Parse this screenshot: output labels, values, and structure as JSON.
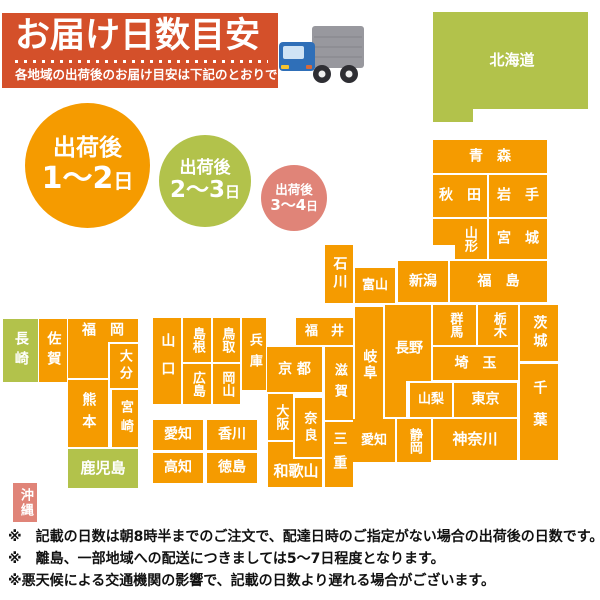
{
  "header": {
    "title": "お届け日数目安",
    "subtitle": "各地域の出荷後のお届け目安は下記のとおりです",
    "bg_color": "#d4502a",
    "truck": {
      "box_color": "#98989e",
      "box_line_color": "#8a8a91",
      "cab_color": "#2f6fb8",
      "window_color": "#cfe3f5",
      "wheel_color": "#2e2e33",
      "hub_color": "#efefef",
      "light_color": "#f5c431"
    }
  },
  "legend": {
    "circles": [
      {
        "prefix": "出荷後",
        "range": "1〜2",
        "unit": "日",
        "color": "#f59b00"
      },
      {
        "prefix": "出荷後",
        "range": "2〜3",
        "unit": "日",
        "color": "#b2c24b"
      },
      {
        "prefix": "出荷後",
        "range": "3〜4",
        "unit": "日",
        "color": "#e08478"
      }
    ]
  },
  "map": {
    "colors": {
      "orange": "#f59b00",
      "green": "#b2c24b",
      "pink": "#e08478"
    },
    "blocks": [
      {
        "id": "hokkaido",
        "label": "北海道",
        "color": "green",
        "fs": 15,
        "rects": [
          [
            433,
            12,
            155,
            97
          ],
          [
            433,
            12,
            40,
            110
          ]
        ],
        "lx": 512,
        "ly": 61
      },
      {
        "id": "aomori",
        "label": "青　森",
        "rects": [
          [
            433,
            140,
            114,
            33
          ]
        ]
      },
      {
        "id": "akita",
        "label": "秋　田",
        "rects": [
          [
            433,
            175,
            54,
            42
          ]
        ]
      },
      {
        "id": "iwate",
        "label": "岩　手",
        "rects": [
          [
            489,
            175,
            58,
            42
          ]
        ]
      },
      {
        "id": "yamagata",
        "label": "山形",
        "vertical": true,
        "fs": 13,
        "rects": [
          [
            433,
            219,
            54,
            26
          ],
          [
            455,
            219,
            32,
            40
          ]
        ],
        "lx": 469,
        "ly": 239
      },
      {
        "id": "miyagi",
        "label": "宮　城",
        "rects": [
          [
            489,
            219,
            58,
            40
          ]
        ]
      },
      {
        "id": "niigata",
        "label": "新潟",
        "rects": [
          [
            398,
            261,
            50,
            41
          ]
        ]
      },
      {
        "id": "fukushima",
        "label": "福　島",
        "rects": [
          [
            450,
            261,
            97,
            41
          ]
        ]
      },
      {
        "id": "ishikawa",
        "label": "石川",
        "vertical": true,
        "ls": 4,
        "rects": [
          [
            325,
            245,
            28,
            58
          ]
        ]
      },
      {
        "id": "toyama",
        "label": "富山",
        "fs": 13,
        "rects": [
          [
            355,
            268,
            40,
            35
          ]
        ]
      },
      {
        "id": "fukui",
        "label": "福　井",
        "fs": 13,
        "rects": [
          [
            296,
            318,
            57,
            27
          ]
        ]
      },
      {
        "id": "gifu",
        "label": "岐阜",
        "vertical": true,
        "ls": 2,
        "rects": [
          [
            355,
            307,
            28,
            115
          ]
        ]
      },
      {
        "id": "nagano",
        "label": "長野",
        "rects": [
          [
            385,
            305,
            46,
            76
          ],
          [
            385,
            305,
            21,
            112
          ]
        ],
        "lx": 409,
        "ly": 349
      },
      {
        "id": "gunma",
        "label": "群馬",
        "vertical": true,
        "fs": 13,
        "rects": [
          [
            433,
            305,
            43,
            40
          ]
        ]
      },
      {
        "id": "tochigi",
        "label": "栃木",
        "vertical": true,
        "fs": 13,
        "rects": [
          [
            478,
            305,
            40,
            40
          ]
        ]
      },
      {
        "id": "ibaraki",
        "label": "茨城",
        "vertical": true,
        "ls": 4,
        "rects": [
          [
            520,
            305,
            38,
            56
          ]
        ]
      },
      {
        "id": "saitama",
        "label": "埼　玉",
        "rects": [
          [
            433,
            347,
            85,
            33
          ]
        ]
      },
      {
        "id": "chiba",
        "label": "千葉",
        "vertical": true,
        "ls": 18,
        "rects": [
          [
            520,
            364,
            38,
            96
          ]
        ]
      },
      {
        "id": "yamanashi",
        "label": "山梨",
        "fs": 13,
        "rects": [
          [
            410,
            383,
            42,
            34
          ]
        ]
      },
      {
        "id": "tokyo",
        "label": "東京",
        "rects": [
          [
            454,
            383,
            63,
            34
          ]
        ]
      },
      {
        "id": "kanagawa",
        "label": "神奈川",
        "fs": 15,
        "rects": [
          [
            433,
            419,
            84,
            41
          ]
        ]
      },
      {
        "id": "shizuoka",
        "label": "静岡",
        "vertical": true,
        "fs": 13,
        "rects": [
          [
            397,
            419,
            34,
            43
          ]
        ]
      },
      {
        "id": "aichi",
        "label": "愛知",
        "fs": 13,
        "rects": [
          [
            353,
            419,
            42,
            43
          ]
        ]
      },
      {
        "id": "mie",
        "label": "三重",
        "vertical": true,
        "ls": 10,
        "rects": [
          [
            325,
            422,
            28,
            65
          ]
        ]
      },
      {
        "id": "shiga",
        "label": "滋賀",
        "vertical": true,
        "fs": 13,
        "ls": 8,
        "rects": [
          [
            325,
            347,
            28,
            73
          ]
        ]
      },
      {
        "id": "kyoto",
        "label": "京 都",
        "rects": [
          [
            267,
            347,
            55,
            45
          ]
        ]
      },
      {
        "id": "osaka",
        "label": "大阪",
        "vertical": true,
        "fs": 13,
        "rects": [
          [
            268,
            394,
            25,
            46
          ]
        ]
      },
      {
        "id": "nara",
        "label": "奈良",
        "vertical": true,
        "fs": 13,
        "ls": 4,
        "rects": [
          [
            295,
            398,
            27,
            59
          ]
        ]
      },
      {
        "id": "wakayama",
        "label": "和歌山",
        "fs": 15,
        "rects": [
          [
            268,
            459,
            54,
            28
          ],
          [
            268,
            442,
            25,
            45
          ]
        ],
        "lx": 296,
        "ly": 472
      },
      {
        "id": "hyogo",
        "label": "兵庫",
        "vertical": true,
        "fs": 13,
        "ls": 8,
        "rects": [
          [
            242,
            318,
            24,
            72
          ]
        ]
      },
      {
        "id": "tottori",
        "label": "鳥取",
        "vertical": true,
        "fs": 13,
        "rects": [
          [
            213,
            318,
            27,
            44
          ]
        ]
      },
      {
        "id": "shimane",
        "label": "島根",
        "vertical": true,
        "fs": 13,
        "rects": [
          [
            183,
            318,
            28,
            44
          ]
        ]
      },
      {
        "id": "okayama",
        "label": "岡山",
        "vertical": true,
        "fs": 13,
        "rects": [
          [
            213,
            364,
            27,
            40
          ]
        ]
      },
      {
        "id": "hiroshima",
        "label": "広島",
        "vertical": true,
        "fs": 13,
        "rects": [
          [
            183,
            364,
            28,
            40
          ]
        ]
      },
      {
        "id": "yamaguchi",
        "label": "山口",
        "vertical": true,
        "ls": 14,
        "rects": [
          [
            153,
            318,
            28,
            86
          ]
        ]
      },
      {
        "id": "ehime",
        "label": "愛知",
        "fs": 14,
        "rects": [
          [
            153,
            420,
            50,
            30
          ]
        ]
      },
      {
        "id": "kagawa",
        "label": "香川",
        "rects": [
          [
            207,
            420,
            50,
            30
          ]
        ]
      },
      {
        "id": "kochi",
        "label": "高知",
        "rects": [
          [
            153,
            453,
            50,
            30
          ]
        ]
      },
      {
        "id": "tokushima",
        "label": "徳島",
        "rects": [
          [
            207,
            453,
            50,
            30
          ]
        ]
      },
      {
        "id": "fukuoka",
        "label": "福　岡",
        "rects": [
          [
            68,
            319,
            70,
            23
          ],
          [
            68,
            319,
            40,
            59
          ]
        ],
        "lx": 103,
        "ly": 331
      },
      {
        "id": "saga",
        "label": "佐賀",
        "vertical": true,
        "ls": 6,
        "rects": [
          [
            39,
            319,
            28,
            63
          ]
        ]
      },
      {
        "id": "nagasaki",
        "label": "長崎",
        "color": "green",
        "vertical": true,
        "ls": 6,
        "rects": [
          [
            3,
            319,
            35,
            63
          ]
        ]
      },
      {
        "id": "oita",
        "label": "大分",
        "vertical": true,
        "fs": 13,
        "ls": 4,
        "rects": [
          [
            110,
            344,
            28,
            44
          ]
        ]
      },
      {
        "id": "kumamoto",
        "label": "熊本",
        "vertical": true,
        "ls": 8,
        "rects": [
          [
            68,
            380,
            40,
            67
          ]
        ]
      },
      {
        "id": "miyazaki",
        "label": "宮崎",
        "vertical": true,
        "fs": 13,
        "ls": 6,
        "rects": [
          [
            112,
            390,
            26,
            57
          ]
        ]
      },
      {
        "id": "kagoshima",
        "label": "鹿児島",
        "color": "green",
        "fs": 15,
        "rects": [
          [
            68,
            449,
            70,
            39
          ]
        ]
      },
      {
        "id": "okinawa",
        "label": "沖縄",
        "color": "pink",
        "vertical": true,
        "fs": 13,
        "ls": 2,
        "rects": [
          [
            13,
            483,
            24,
            39
          ]
        ]
      }
    ]
  },
  "notes": {
    "lines": [
      "※　記載の日数は朝8時半までのご注文で、配達日時のご指定がない場合の出荷後の日数です。",
      "※　離島、一部地域への配送につきましては5〜7日程度となります。",
      "※悪天候による交通機関の影響で、記載の日数より遅れる場合がございます。"
    ]
  }
}
